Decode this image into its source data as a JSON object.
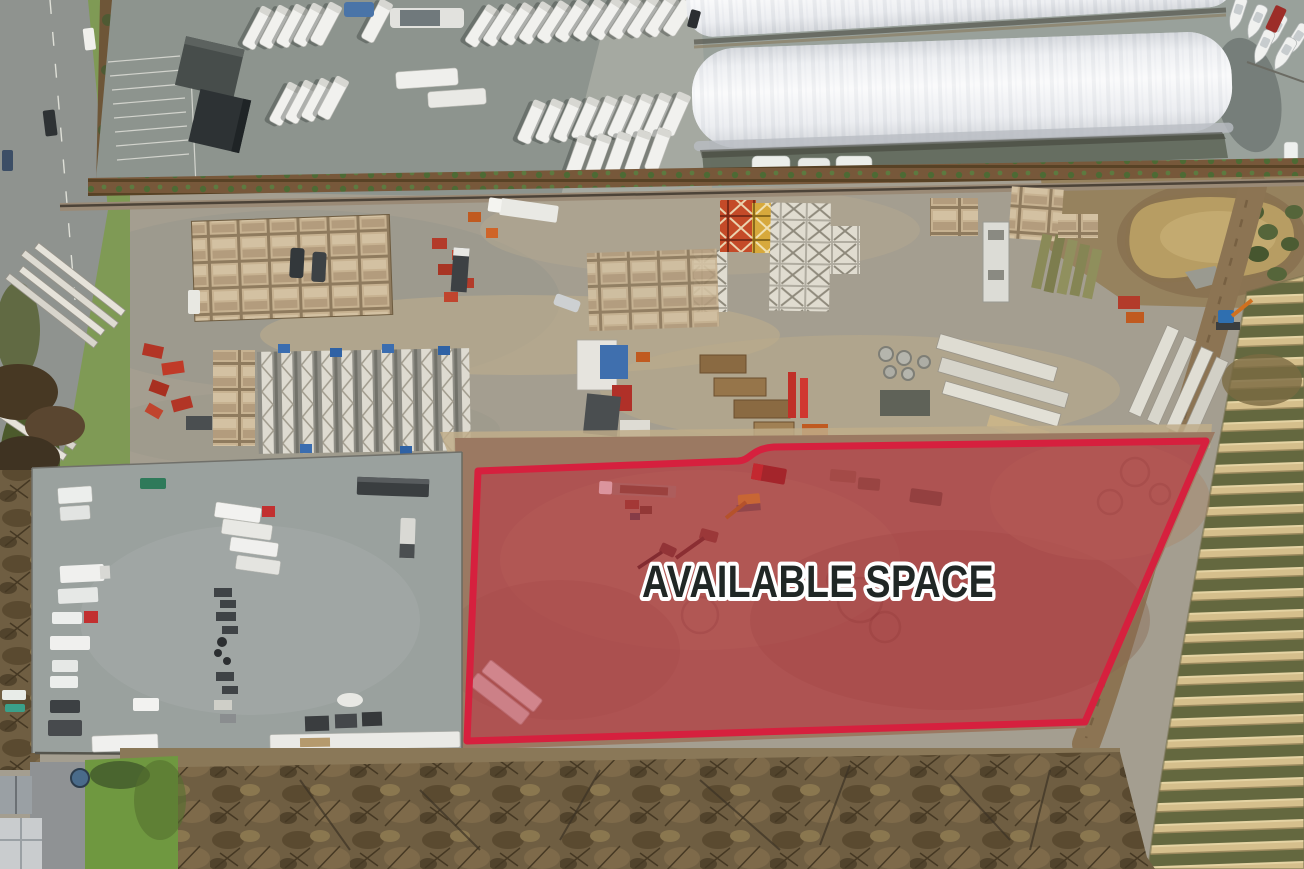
{
  "overlay": {
    "label": "AVAILABLE SPACE",
    "region_fill": "#c7203c",
    "region_fill_opacity": "0.42",
    "region_stroke": "#d6203e",
    "region_stroke_width": "7",
    "label_color": "#202725",
    "label_outline": "#ffffff"
  }
}
